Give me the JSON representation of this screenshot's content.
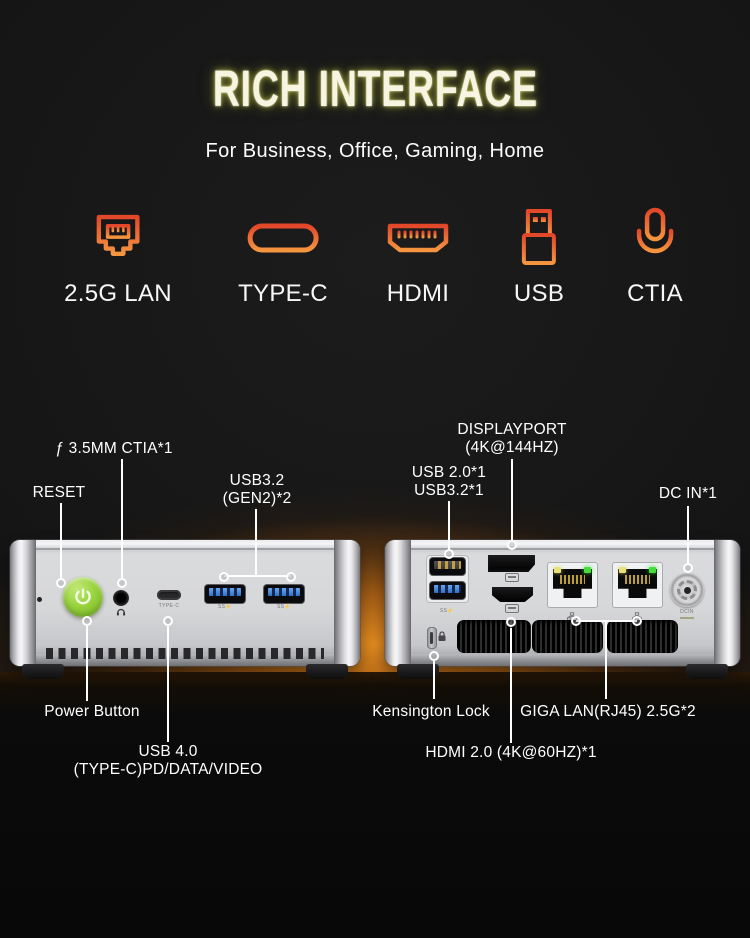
{
  "header": {
    "title": "RICH INTERFACE",
    "subtitle": "For Business, Office, Gaming, Home"
  },
  "interface_icons": [
    {
      "icon": "lan-port-icon",
      "label": "2.5G LAN"
    },
    {
      "icon": "usb-c-icon",
      "label": "TYPE-C"
    },
    {
      "icon": "hdmi-icon",
      "label": "HDMI"
    },
    {
      "icon": "usb-a-icon",
      "label": "USB"
    },
    {
      "icon": "microphone-icon",
      "label": "CTIA"
    }
  ],
  "front_view": {
    "callouts": {
      "audio": "ƒ 3.5MM CTIA*1",
      "reset": "RESET",
      "usb32_line1": "USB3.2",
      "usb32_line2": "(GEN2)*2",
      "power": "Power Button",
      "usb4_line1": "USB 4.0",
      "usb4_line2": "(TYPE-C)PD/DATA/VIDEO"
    },
    "port_labels": {
      "type_c": "TYPE-C",
      "superspeed": "SS⚡"
    }
  },
  "rear_view": {
    "callouts": {
      "displayport_line1": "DISPLAYPORT",
      "displayport_line2": "(4K@144HZ)",
      "usb_line1": "USB 2.0*1",
      "usb_line2": "USB3.2*1",
      "dc_in": "DC IN*1",
      "kensington": "Kensington Lock",
      "giga_lan": "GIGA LAN(RJ45) 2.5G*2",
      "hdmi": "HDMI 2.0 (4K@60HZ)*1"
    },
    "port_labels": {
      "superspeed": "SS⚡",
      "dc_in": "DCIN"
    }
  },
  "colors": {
    "icon_gradient_top": "#e2472a",
    "icon_gradient_bottom": "#f5953f",
    "title_glow": "#c8cc52",
    "background_glow": "#d07b1c",
    "power_button_green": "#92d03a",
    "usb3_blue": "#3f7ed6",
    "lan_led_green": "#44dd3c",
    "lan_led_yellow": "#e9e27a"
  }
}
